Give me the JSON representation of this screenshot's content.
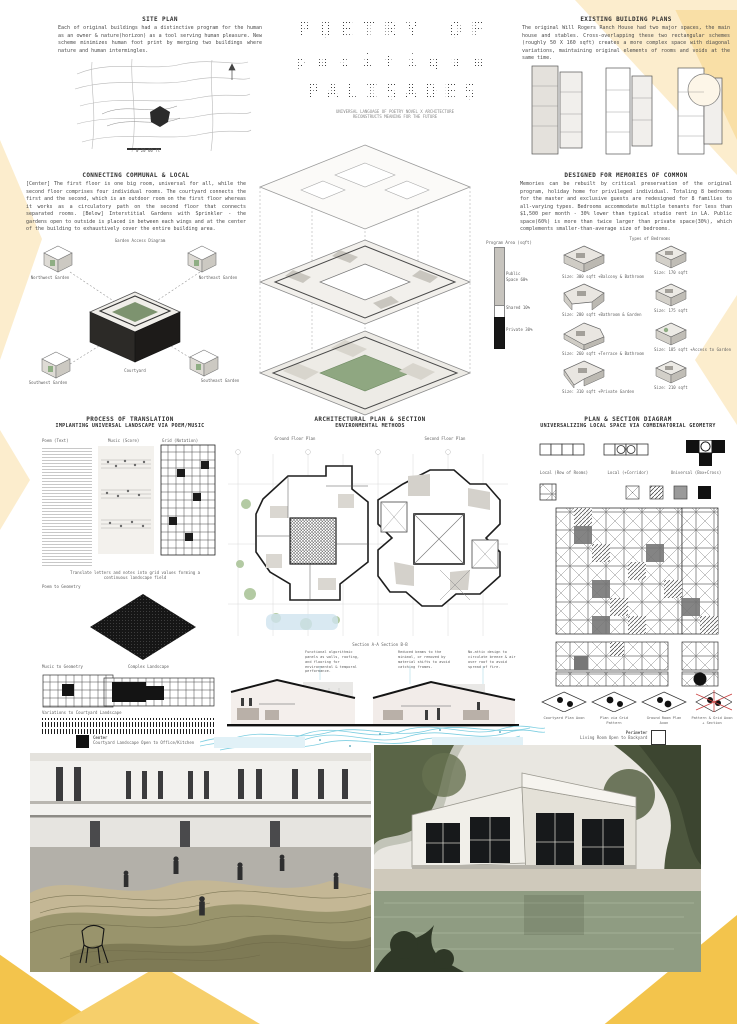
{
  "board": {
    "title_line1": "POETRY OF",
    "title_line2": "pacifique",
    "title_line3": "PALISADES",
    "subtitle_line1": "UNIVERSAL LANGUAGE OF POETRY NOVEL X ARCHITECTURE",
    "subtitle_line2": "RECONSTRUCTS MEANING FOR THE FUTURE"
  },
  "site_plan": {
    "heading": "SITE PLAN",
    "body": "Each of original buildings had a distinctive program for the human as an owner & nature(horizon) as a tool serving human pleasure. New scheme minimizes human foot print by merging two buildings where nature and human intermingles.",
    "scale_label": "0   20   60 ft",
    "north_label": "N"
  },
  "existing": {
    "heading": "EXISTING BUILDING PLANS",
    "body": "The original Will Rogers Ranch House had two major spaces, the main house and stables. Cross-overlapping these two rectangular schemes (roughly 50 X 160 sqft) creates a more complex space with diagonal variations, maintaining original elements of rooms and voids at the same time."
  },
  "connecting": {
    "heading": "CONNECTING COMMUNAL & LOCAL",
    "body": "[Center] The first floor is one big room, universal for all, while the second floor comprises four individual rooms. The courtyard connects the first and the second, which is an outdoor room on the first floor whereas it works as a circulatory path on the second floor that connects separated rooms. [Below] Interstitial Gardens with Sprinkler - the gardens open to outside is placed in between each wings and at the center of the building to exhaustively cover the entire building area.",
    "cluster_title": "Garden Access Diagram",
    "label_nw": "Northwest Garden",
    "label_ne": "Northeast Garden",
    "label_sw": "Southwest Garden",
    "label_se": "Southeast Garden",
    "label_center": "Courtyard"
  },
  "memories": {
    "heading": "DESIGNED FOR MEMORIES OF COMMON",
    "body": "Memories can be rebuilt by critical preservation of the original program, holiday home for privileged individual. Totaling 8 bedrooms for the master and exclusive guests are redesigned for 8 families to all-varying types. Bedrooms accommodate multiple tenants for less than $1,500 per month - 30% lower than typical studio rent in LA. Public space(60%) is more than twice larger than private space(30%), which complements smaller-than-average size of bedrooms."
  },
  "program_bar": {
    "title": "Program Area (sqft)",
    "seg1": "Public Space 60%",
    "seg2": "Shared 10%",
    "seg3": "Private 30%"
  },
  "bedrooms": {
    "title": "Types of Bedrooms",
    "items": [
      {
        "label": "Size: 300 sqft  +Balcony & Bathroom"
      },
      {
        "label": "Size: 170 sqft"
      },
      {
        "label": "Size: 280 sqft  +Bathroom & Garden"
      },
      {
        "label": "Size: 175 sqft"
      },
      {
        "label": "Size: 260 sqft  +Terrace & Bathroom"
      },
      {
        "label": "Size: 185 sqft  +Access to Garden"
      },
      {
        "label": "Size: 310 sqft  +Private Garden"
      },
      {
        "label": "Size: 210 sqft"
      }
    ]
  },
  "process": {
    "heading": "PROCESS OF TRANSLATION",
    "subheading": "IMPLANTING UNIVERSAL LANDSCAPE VIA POEM/MUSIC",
    "panel1": "Poem (Text)",
    "panel2": "Music (Score)",
    "panel3": "Grid (Notation)",
    "caption": "Translate letters and notes into grid values forming a continuous landscape field",
    "step1": "Poem to Geometry",
    "step2": "Music to Geometry",
    "step3": "Complex Landscape",
    "step4": "Variations to Courtyard Landscape"
  },
  "plans": {
    "heading": "ARCHITECTURAL PLAN & SECTION",
    "subheading": "ENVIRONMENTAL METHODS",
    "ground_label": "Ground Floor Plan",
    "second_label": "Second Floor Plan"
  },
  "sections": {
    "label": "Section A-A        Section B-B",
    "callout1": "Functional algorithmic panels as walls, roofing, and flooring for environmental & temporal performance.",
    "callout2": "Reduced beams to the minimal, or removed by material shifts to avoid catching frames.",
    "callout3": "No-attic design to circulate breeze & air over roof to avoid spread of fire."
  },
  "diagram": {
    "heading": "PLAN & SECTION DIAGRAM",
    "subheading": "UNIVERSALIZING LOCAL SPACE VIA COMBINATORIAL GEOMETRY",
    "top1": "Local (Row of Rooms)",
    "top2": "Local (+Corridor)",
    "top3": "Universal (Box+Cross)",
    "bottom1": "Courtyard Plan Axon",
    "bottom2": "Plan via Grid Pattern",
    "bottom3": "Ground Room Plan Axon",
    "bottom4": "Pattern & Grid Axon + Section"
  },
  "banner": {
    "left": "POETRY OF",
    "right": "PALISADES"
  },
  "captions": {
    "left_title": "Center",
    "left_sub": "Courtyard Landscape Open to Office/Kitchen",
    "right_title": "Perimeter",
    "right_sub": "Living Room Open to Backyard"
  },
  "colors": {
    "accent_yellow": "#f3c44c",
    "pale_yellow": "#fcedcd",
    "cyan": "#6fc9de",
    "ink": "#2e2e2e"
  }
}
